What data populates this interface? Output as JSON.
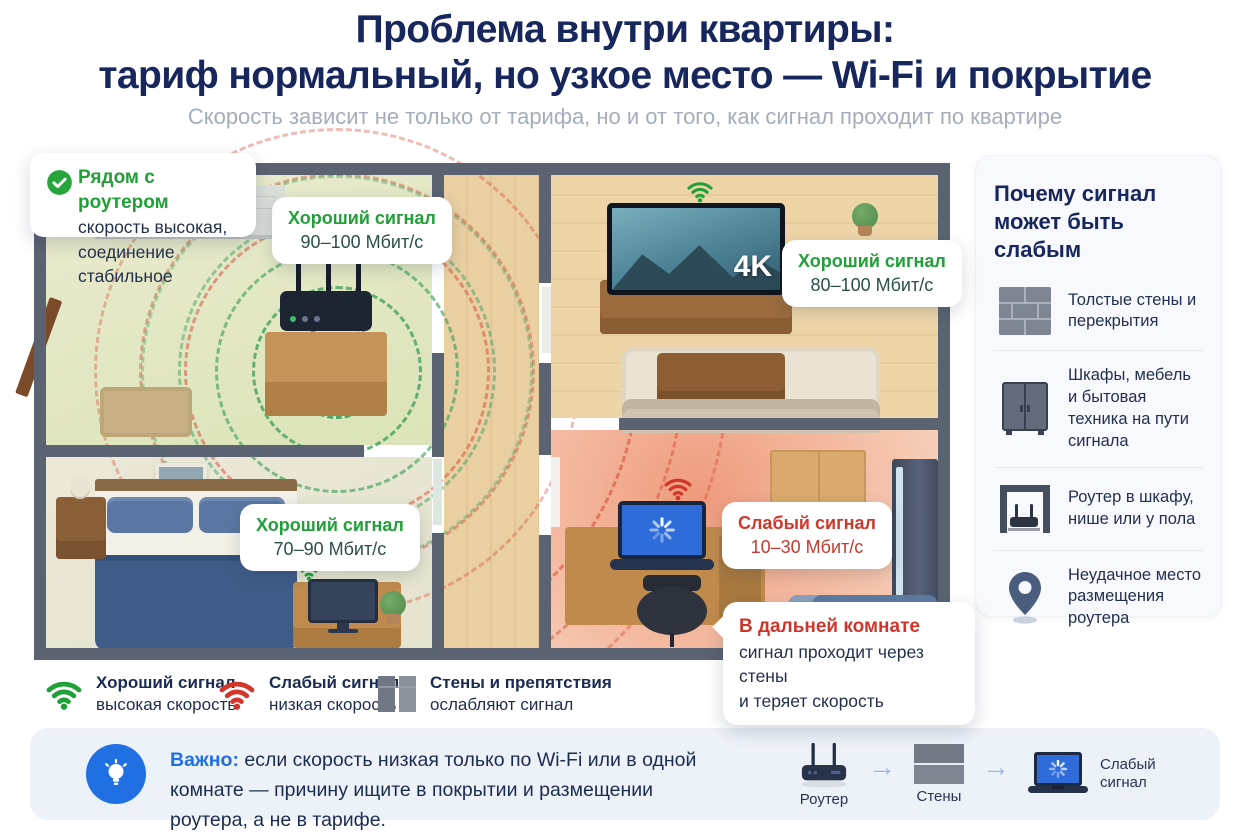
{
  "header": {
    "title_line1": "Проблема внутри квартиры:",
    "title_line2": "тариф нормальный, но узкое место — Wi-Fi и покрытие",
    "subtitle": "Скорость зависит не только от тарифа, но и от того, как сигнал проходит по квартире"
  },
  "colors": {
    "navy": "#17265c",
    "green": "#21a038",
    "red": "#d2362b",
    "blue": "#2070e4",
    "wall": "#5b6271"
  },
  "floorplan": {
    "callout_router": {
      "icon": "check-circle-icon",
      "title": "Рядом с роутером",
      "line1": "скорость высокая,",
      "line2": "соединение стабильное"
    },
    "labels": {
      "hall": {
        "title": "Хороший сигнал",
        "value": "90–100 Мбит/с"
      },
      "living": {
        "title": "Хороший сигнал",
        "value": "80–100 Мбит/с"
      },
      "bedroom": {
        "title": "Хороший сигнал",
        "value": "70–90 Мбит/с"
      },
      "office": {
        "title": "Слабый сигнал",
        "value": "10–30 Мбит/с"
      }
    },
    "tv_badge": "4K",
    "callout_far": {
      "title": "В дальней комнате",
      "line1": "сигнал проходит через стены",
      "line2": "и теряет скорость"
    }
  },
  "sidebar": {
    "title_line1": "Почему сигнал",
    "title_line2": "может быть слабым",
    "items": [
      {
        "icon": "brick-wall-icon",
        "text": "Толстые стены и перекрытия"
      },
      {
        "icon": "cabinet-icon",
        "text": "Шкафы, мебель и бытовая техника на пути сигнала"
      },
      {
        "icon": "router-in-niche-icon",
        "text": "Роутер в шкафу, нише или у пола"
      },
      {
        "icon": "map-pin-icon",
        "text": "Неудачное место размещения роутера"
      }
    ]
  },
  "legend": {
    "items": [
      {
        "icon": "wifi-good-icon",
        "title": "Хороший сигнал",
        "subtitle": "высокая скорость"
      },
      {
        "icon": "wifi-weak-icon",
        "title": "Слабый сигнал",
        "subtitle": "низкая скорость"
      },
      {
        "icon": "wall-icon",
        "title": "Стены и препятствия",
        "subtitle": "ослабляют сигнал"
      }
    ]
  },
  "note": {
    "icon": "lightbulb-icon",
    "label": "Важно:",
    "text": " если скорость низкая только по Wi-Fi или в одной комнате — причину ищите в покрытии и размещении роутера, а не в тарифе.",
    "arrow": "→",
    "flow": [
      {
        "icon": "router-icon",
        "label": "Роутер"
      },
      {
        "icon": "wall-icon",
        "label": "Стены"
      },
      {
        "icon": "laptop-loading-icon",
        "label": "Слабый сигнал"
      }
    ]
  }
}
